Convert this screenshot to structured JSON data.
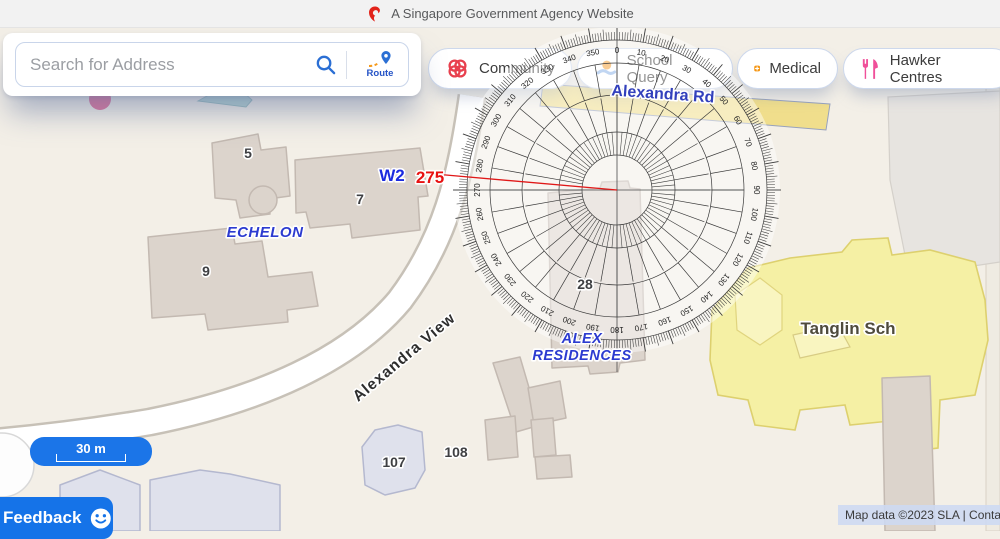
{
  "banner": {
    "logo": "merlion-icon",
    "text": "A Singapore Government Agency Website"
  },
  "search": {
    "placeholder": "Search for Address",
    "search_icon": "magnifier-icon",
    "route_label": "Route",
    "route_icon": "route-pin-icon"
  },
  "categories": [
    {
      "label": "Community",
      "icon": "community-rings-icon",
      "icon_color": "#e8404e"
    },
    {
      "label": "School Query",
      "icon": "school-icon",
      "icon_color": "#f5a23c"
    },
    {
      "label": "Medical",
      "icon": "medical-cross-icon",
      "icon_color": "#f5940f"
    },
    {
      "label": "Hawker Centres",
      "icon": "fork-knife-icon",
      "icon_color": "#f0509a"
    }
  ],
  "map": {
    "road_labels": {
      "alexandra_rd": "Alexandra Rd",
      "alexandra_view": "Alexandra View"
    },
    "area_labels": {
      "echelon": "ECHELON",
      "alex_residences_line1": "ALEX",
      "alex_residences_line2": "RESIDENCES",
      "tanglin_school": "Tanglin Sch"
    },
    "building_numbers": {
      "b5": "5",
      "b7": "7",
      "b9": "9",
      "b28": "28",
      "b107": "107",
      "b108": "108"
    },
    "scale_label": "30 m",
    "attribution": "Map data ©2023 SLA | Contac",
    "feedback_label": "Feedback"
  },
  "bearing": {
    "ref_label": "W2",
    "value_label": "275",
    "degrees": 275,
    "line_color": "#e01818",
    "ref_color": "#1c2bdf",
    "value_color": "#e81212"
  },
  "protractor": {
    "bearing_deg": 275,
    "labels": [
      "0",
      "10",
      "20",
      "30",
      "40",
      "50",
      "60",
      "70",
      "80",
      "90",
      "100",
      "110",
      "120",
      "130",
      "140",
      "150",
      "160",
      "170",
      "180",
      "190",
      "200",
      "210",
      "220",
      "230",
      "240",
      "250",
      "260",
      "270",
      "280",
      "290",
      "300",
      "310",
      "320",
      "330",
      "340",
      "350"
    ]
  }
}
